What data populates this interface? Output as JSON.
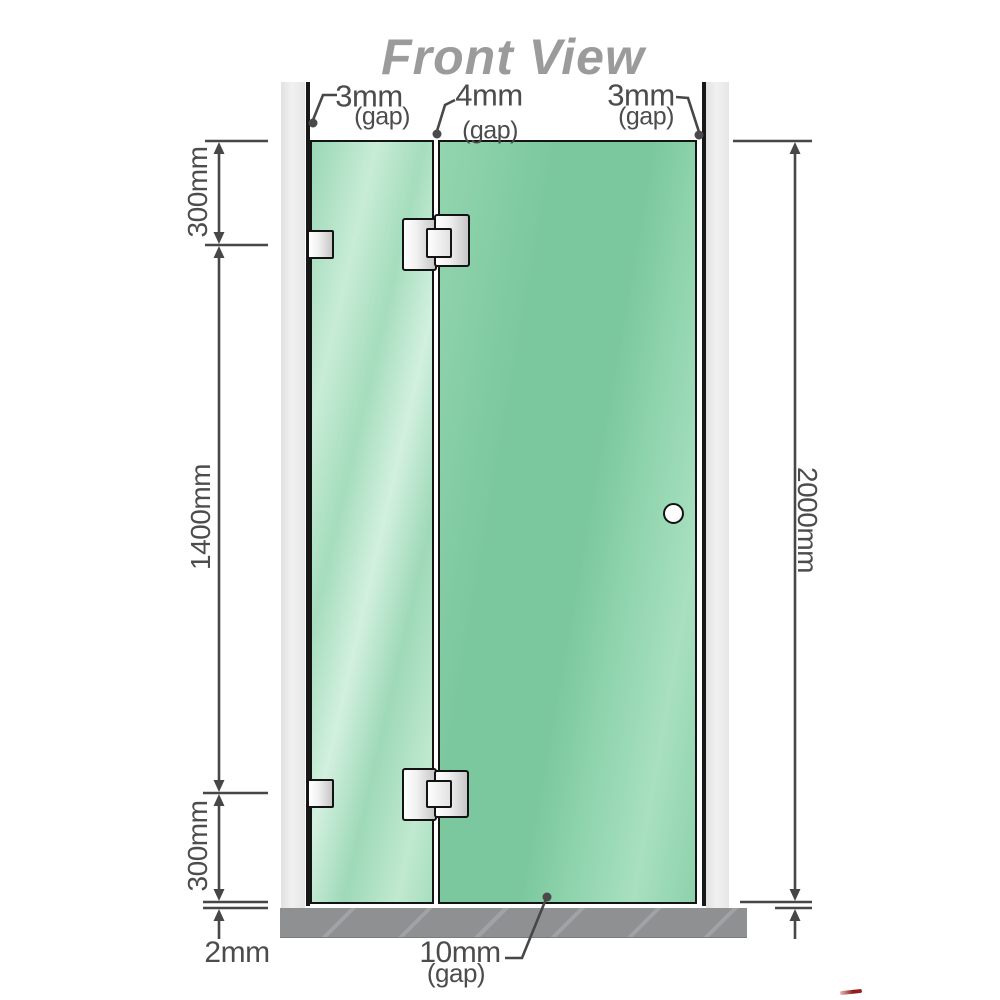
{
  "title": "Front View",
  "labels": {
    "gap_top_left": {
      "value": "3mm",
      "suffix": "(gap)"
    },
    "gap_top_middle": {
      "value": "4mm",
      "suffix": "(gap)"
    },
    "gap_top_right": {
      "value": "3mm",
      "suffix": "(gap)"
    },
    "dim_left_top": "300mm",
    "dim_left_middle": "1400mm",
    "dim_left_bottom": "300mm",
    "dim_floor_gap": "2mm",
    "dim_right_height": "2000mm",
    "gap_bottom": {
      "value": "10mm",
      "suffix": "(gap)"
    }
  },
  "colors": {
    "glass_green": "#7cc89e",
    "glass_highlight": "#d2f0de",
    "wall_gray": "#ececec",
    "floor_gray": "#8e9092",
    "line_gray": "#474747",
    "title_gray": "#9b9b9b",
    "watermark_red": "#8c1a1a"
  }
}
